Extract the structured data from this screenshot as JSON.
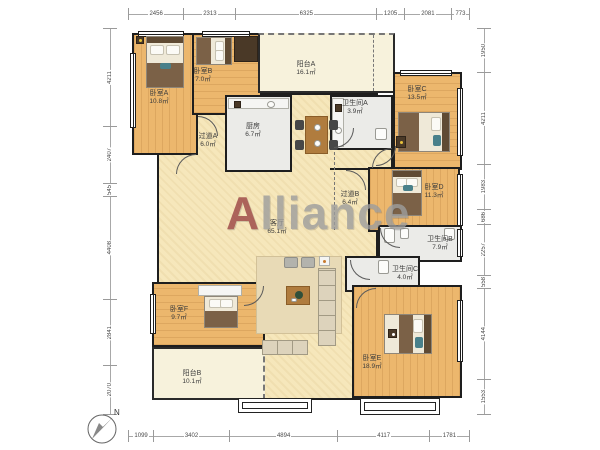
{
  "watermark": {
    "first_letter": "A",
    "rest": "lliance",
    "accent_color": "#9a4444",
    "text_color": "#9d9d9d"
  },
  "compass": {
    "label": "N"
  },
  "palette": {
    "wall": "#1e1e1e",
    "bedroom_floor": "#ecb76d",
    "hall_floor": "#f6e7bb",
    "balcony_floor": "#f7f2dc",
    "wet_floor": "#ebebe8"
  },
  "dimensions": {
    "top": [
      "2456",
      "2313",
      "6325",
      "1205",
      "2081",
      "773"
    ],
    "bottom": [
      "1099",
      "3402",
      "4894",
      "4117",
      "1781"
    ],
    "left": [
      "4211",
      "2407",
      "545",
      "4408",
      "2841",
      "2070"
    ],
    "right": [
      "1950",
      "4211",
      "1983",
      "686",
      "2257",
      "558",
      "4144",
      "1553"
    ]
  },
  "rooms": [
    {
      "id": "bedroom-a",
      "name": "卧室A",
      "area": "10.8㎡"
    },
    {
      "id": "bedroom-b",
      "name": "卧室B",
      "area": "7.0㎡"
    },
    {
      "id": "balcony-a",
      "name": "阳台A",
      "area": "16.1㎡"
    },
    {
      "id": "kitchen",
      "name": "厨房",
      "area": "6.7㎡"
    },
    {
      "id": "hallway-a",
      "name": "过道A",
      "area": "6.0㎡"
    },
    {
      "id": "bathroom-a",
      "name": "卫生间A",
      "area": "3.9㎡"
    },
    {
      "id": "bedroom-c",
      "name": "卧室C",
      "area": "13.5㎡"
    },
    {
      "id": "bedroom-d",
      "name": "卧室D",
      "area": "11.3㎡"
    },
    {
      "id": "hallway-b",
      "name": "过道B",
      "area": "6.4㎡"
    },
    {
      "id": "living-room",
      "name": "客厅",
      "area": "65.1㎡"
    },
    {
      "id": "bathroom-b",
      "name": "卫生间B",
      "area": "7.9㎡"
    },
    {
      "id": "bathroom-c",
      "name": "卫生间C",
      "area": "4.0㎡"
    },
    {
      "id": "bedroom-e",
      "name": "卧室E",
      "area": "18.9㎡"
    },
    {
      "id": "bedroom-f",
      "name": "卧室F",
      "area": "9.7㎡"
    },
    {
      "id": "balcony-b",
      "name": "阳台B",
      "area": "10.1㎡"
    }
  ]
}
